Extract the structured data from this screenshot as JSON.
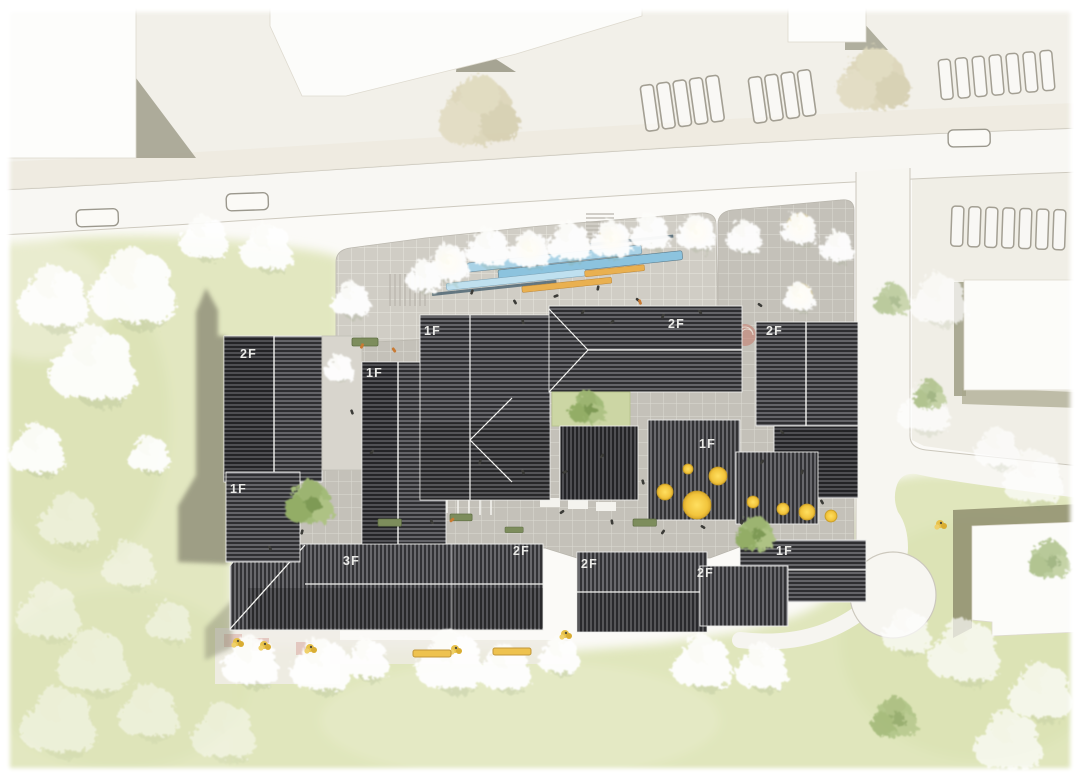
{
  "meta": {
    "kind": "architectural site plan",
    "style": "top-down watercolor masterplan rendering",
    "site": "mixed-use block with central plazas, surrounded by roads, parking and lawns"
  },
  "floor_labels": [
    {
      "building": "west-north-wing",
      "label": "2F"
    },
    {
      "building": "mid-west-bar",
      "label": "1F"
    },
    {
      "building": "center-north-west",
      "label": "1F"
    },
    {
      "building": "center-north-east",
      "label": "2F"
    },
    {
      "building": "east-wing",
      "label": "2F"
    },
    {
      "building": "center-south-east",
      "label": "1F"
    },
    {
      "building": "west-south-bar",
      "label": "1F"
    },
    {
      "building": "south-main-block",
      "label": "3F"
    },
    {
      "building": "south-main-east-end",
      "label": "2F"
    },
    {
      "building": "south-middle-block",
      "label": "2F"
    },
    {
      "building": "south-east-block",
      "label": "2F"
    },
    {
      "building": "south-east-low-bar",
      "label": "1F"
    }
  ],
  "colors": {
    "lawn": "#e2e7c0",
    "paving_light": "#d0cdc5",
    "paving_dark": "#c4c1b9",
    "roof_dark": "#2e2e31",
    "roof_hatch": "#a7a7ad",
    "road": "#f8f7f3",
    "shadow_olive": "#8e8d77",
    "tree_white": "#ffffff",
    "tree_tan": "#dcd5b8",
    "tree_green": "#a3bb79",
    "tree_yellow": "#f2c53d",
    "lamp_glow": "#ffd84a",
    "canopy_blue": "#9fcbe2",
    "bench_orange": "#e9b050",
    "bench_green": "#7d8d5c",
    "accent_pink": "#d8a49c"
  }
}
